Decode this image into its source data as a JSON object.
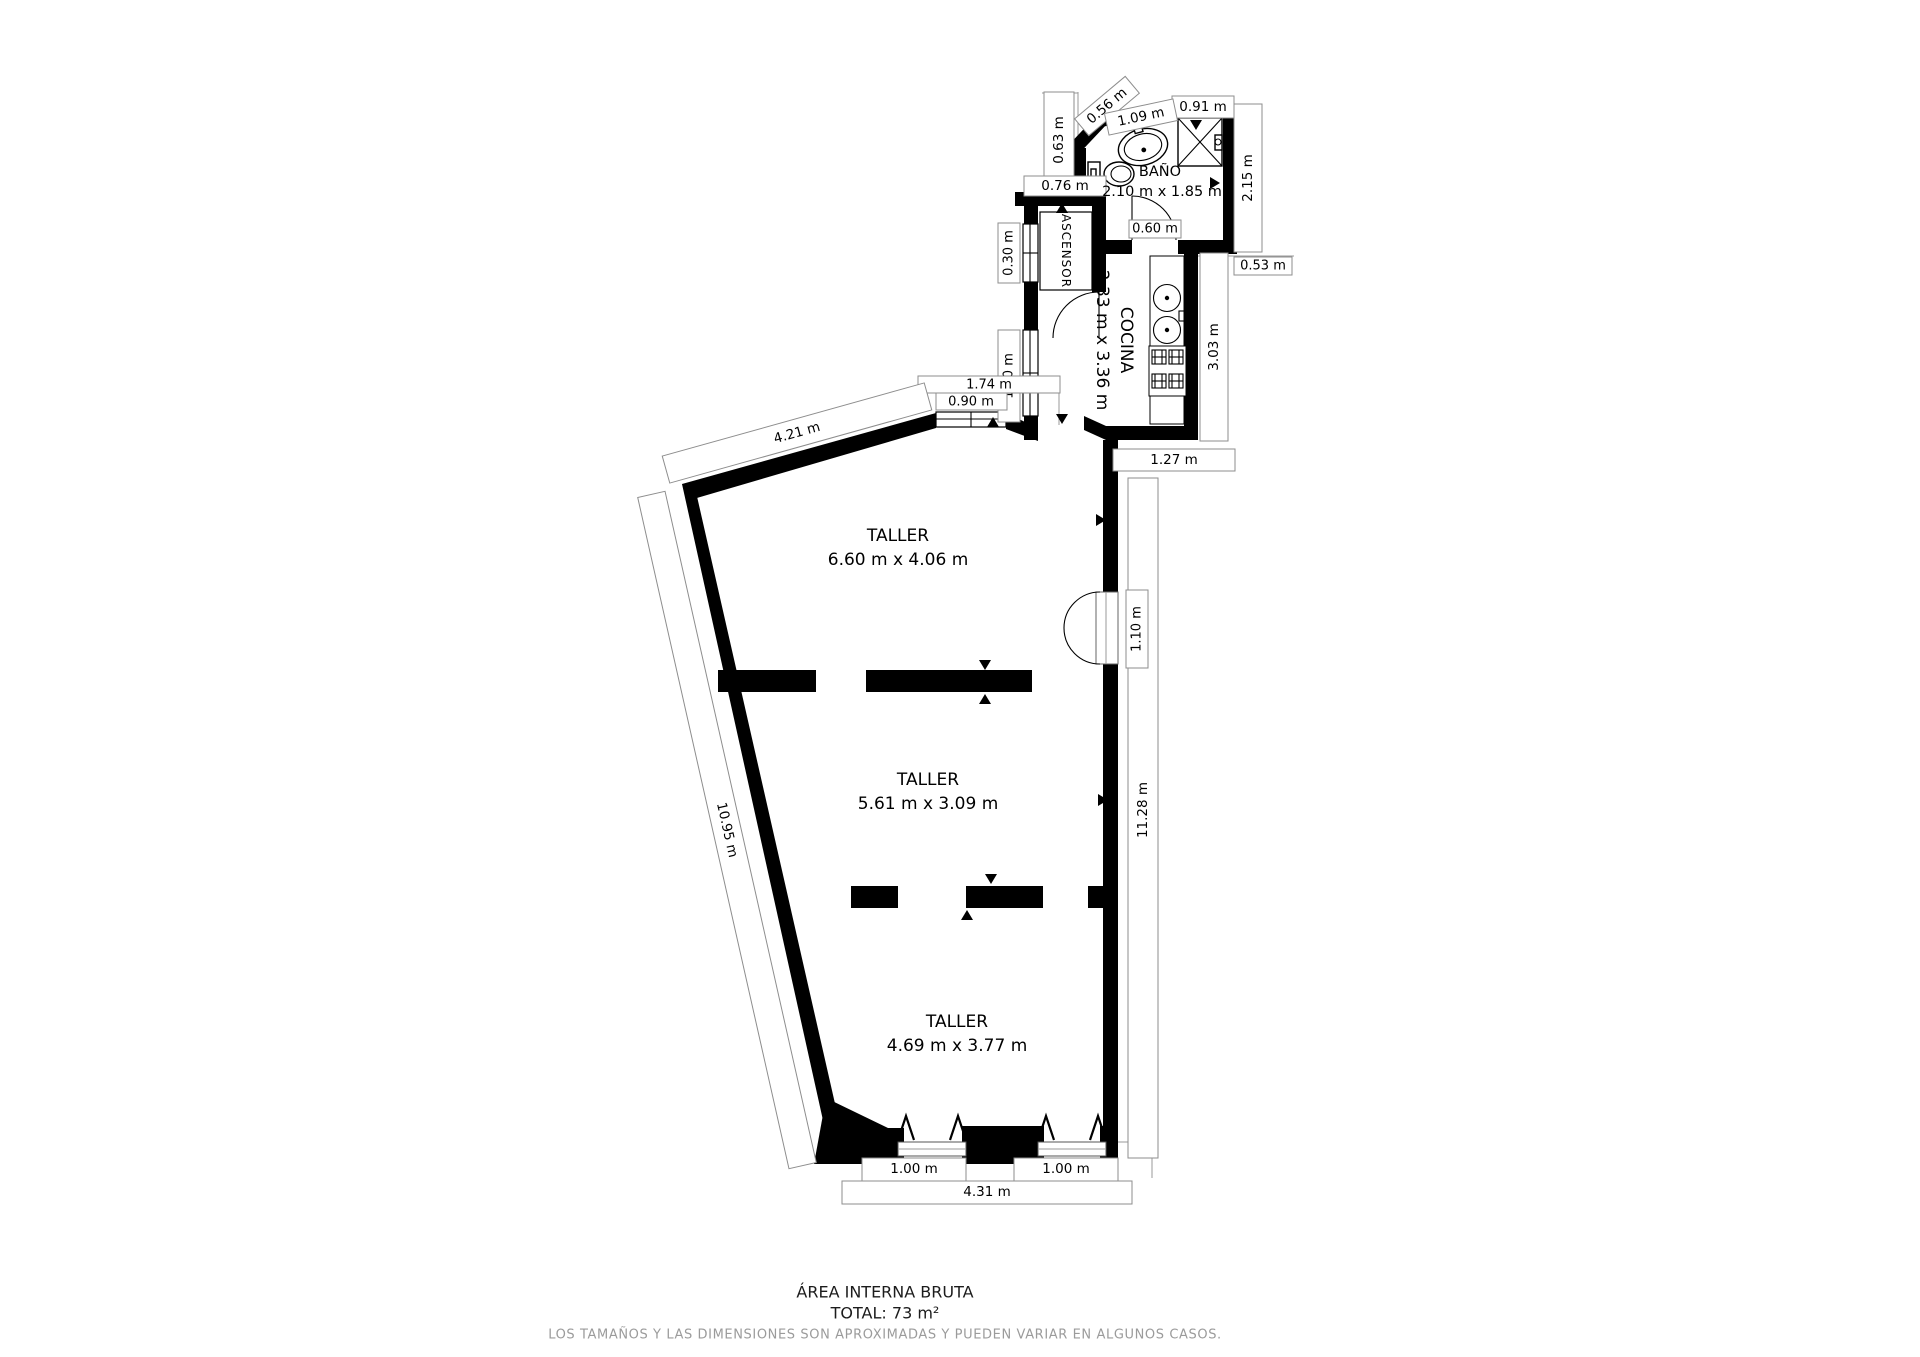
{
  "plan": {
    "rooms": {
      "bathroom": {
        "name": "BAÑO",
        "dims": "2.10 m x 1.85 m"
      },
      "kitchen": {
        "name": "COCINA",
        "dims": "2.33 m x 3.36 m"
      },
      "elevator": {
        "name": "ASCENSOR"
      },
      "workshop1": {
        "name": "TALLER",
        "dims": "6.60 m x 4.06 m"
      },
      "workshop2": {
        "name": "TALLER",
        "dims": "5.61 m x 3.09 m"
      },
      "workshop3": {
        "name": "TALLER",
        "dims": "4.69 m x 3.77 m"
      }
    },
    "measurements": {
      "m056": "0.56 m",
      "m109": "1.09 m",
      "m091": "0.91 m",
      "m063": "0.63 m",
      "m215": "2.15 m",
      "m076": "0.76 m",
      "m060": "0.60 m",
      "m053": "0.53 m",
      "m030": "0.30 m",
      "m303": "3.03 m",
      "m120": "1.20 m",
      "m174": "1.74 m",
      "m090": "0.90 m",
      "m421": "4.21 m",
      "m127": "1.27 m",
      "m110": "1.10 m",
      "m1128": "11.28 m",
      "m1095": "10.95 m",
      "m100a": "1.00 m",
      "m100b": "1.00 m",
      "m431": "4.31 m"
    },
    "colors": {
      "wall": "#000000",
      "dim_border": "#8d8d8d",
      "disclaimer": "#9b9b9b"
    }
  },
  "footer": {
    "title": "ÁREA INTERNA BRUTA",
    "total": "TOTAL: 73 m²",
    "disclaimer": "LOS TAMAÑOS Y LAS DIMENSIONES SON APROXIMADAS Y PUEDEN VARIAR EN ALGUNOS CASOS."
  }
}
